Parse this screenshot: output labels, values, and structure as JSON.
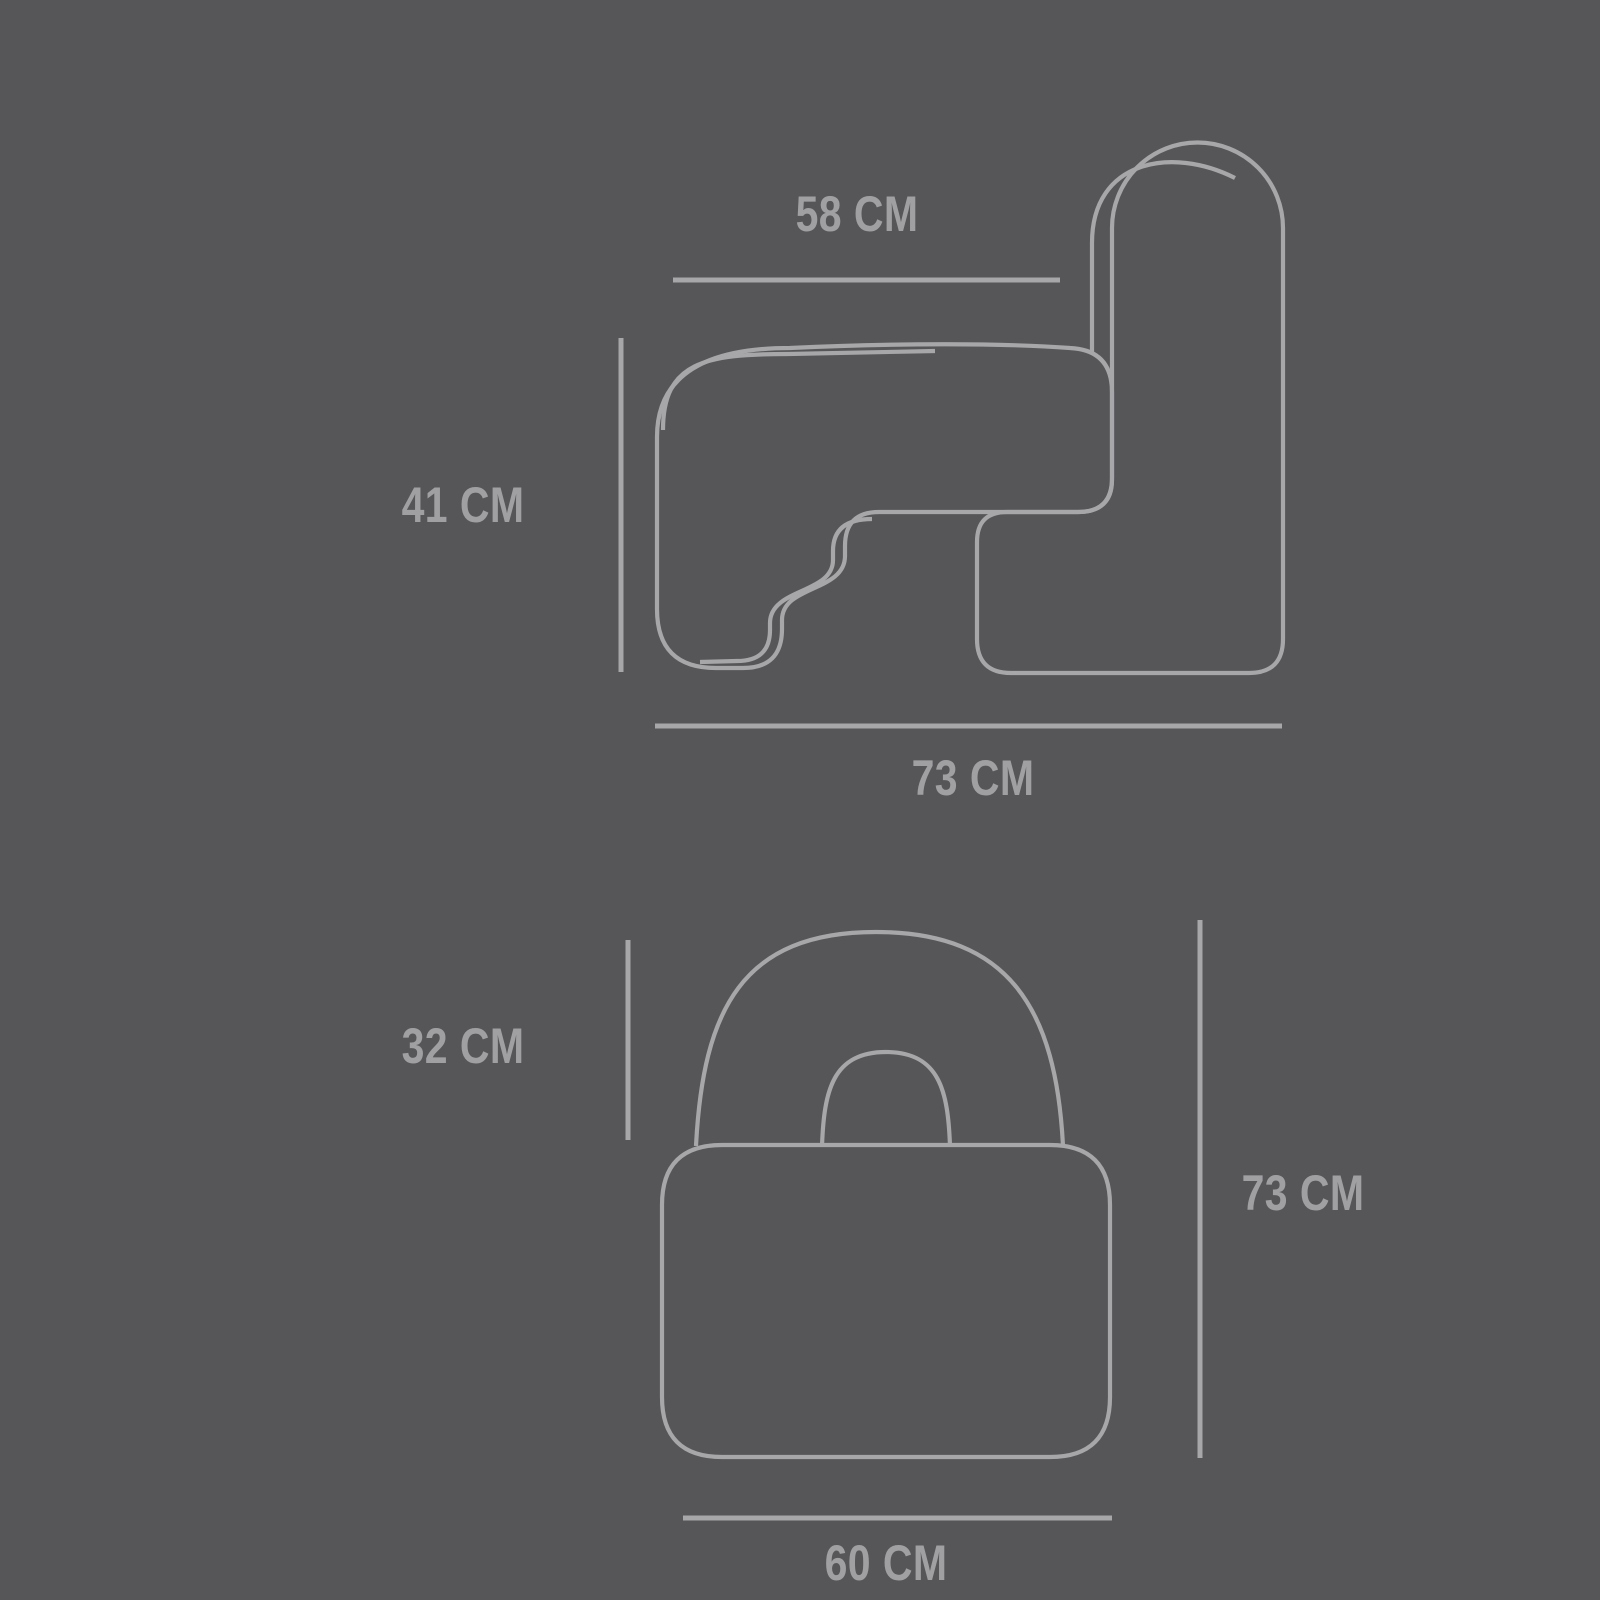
{
  "title": "chair-dimensions-diagram",
  "unit": "CM",
  "colors": {
    "background": "#565659",
    "line": "#a7a7a9",
    "text": "#a0a0a3"
  },
  "side_view": {
    "name": "side view",
    "dims": {
      "seat_top_width": "58 CM",
      "seat_height": "41 CM",
      "total_depth": "73 CM"
    }
  },
  "front_view": {
    "name": "front view",
    "dims": {
      "backrest_height": "32 CM",
      "total_height": "73 CM",
      "seat_width": "60 CM"
    }
  }
}
